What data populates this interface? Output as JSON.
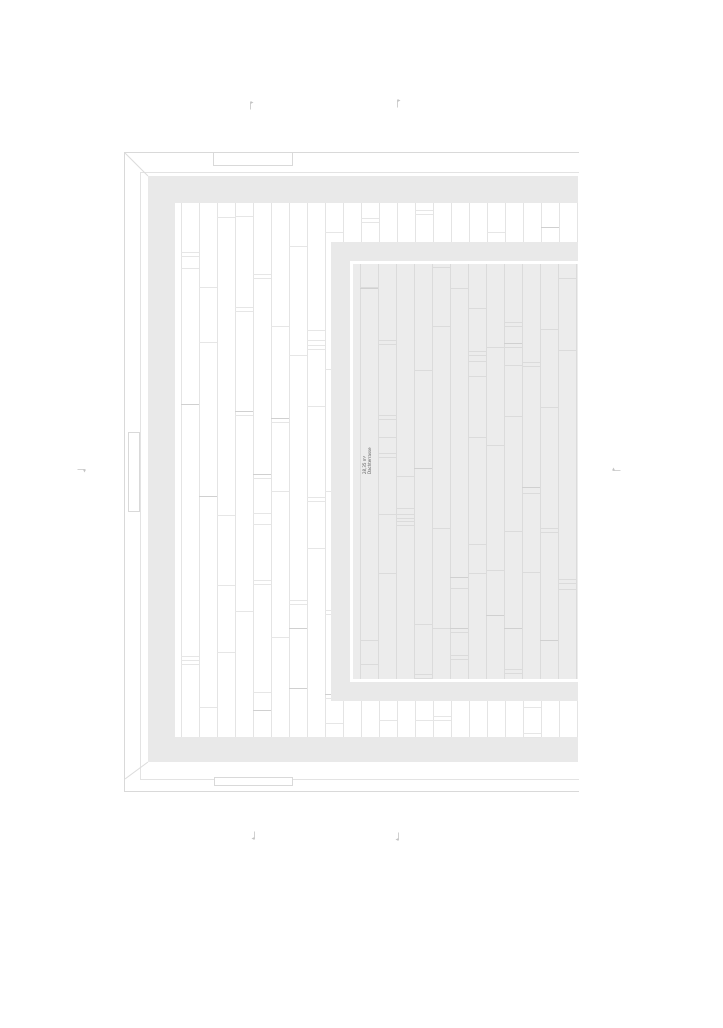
{
  "drawing": {
    "room_label": {
      "line1": "28,35 m²",
      "line2": "Dachterrasse"
    },
    "colors": {
      "band": "#e9e9e9",
      "terrace_fill": "#ececec",
      "frame_line": "#d9d9d9",
      "frame_line_light": "#e3e3e3",
      "plank_line_white": "#e4e4e4",
      "plank_line_gray": "#dbdbdb",
      "joint_light": "#e6e6e6",
      "joint_dark": "#d0d0d0",
      "miter_line": "#dcdcdc",
      "marker": "#c4c4c4",
      "label_text": "#5a5a5a"
    },
    "markers": [
      {
        "name": "section-marker-top-left",
        "x": 247,
        "y": 95,
        "rot": 0
      },
      {
        "name": "section-marker-top-right",
        "x": 394,
        "y": 93,
        "rot": 0
      },
      {
        "name": "section-marker-left",
        "x": 83,
        "y": 465,
        "rot": 90
      },
      {
        "name": "section-marker-right",
        "x": 607,
        "y": 465,
        "rot": -90
      },
      {
        "name": "section-marker-bottom-left",
        "x": 250,
        "y": 836,
        "rot": 180
      },
      {
        "name": "section-marker-bottom-right",
        "x": 394,
        "y": 837,
        "rot": 180
      }
    ],
    "plank_pattern": {
      "white_area": {
        "x0": 181,
        "y0": 206,
        "col_width": 18,
        "cols": 21,
        "y1": 734
      },
      "gray_area": {
        "x0": 360,
        "y0": 267,
        "col_width": 18,
        "cols": 12,
        "y1": 676
      }
    }
  }
}
